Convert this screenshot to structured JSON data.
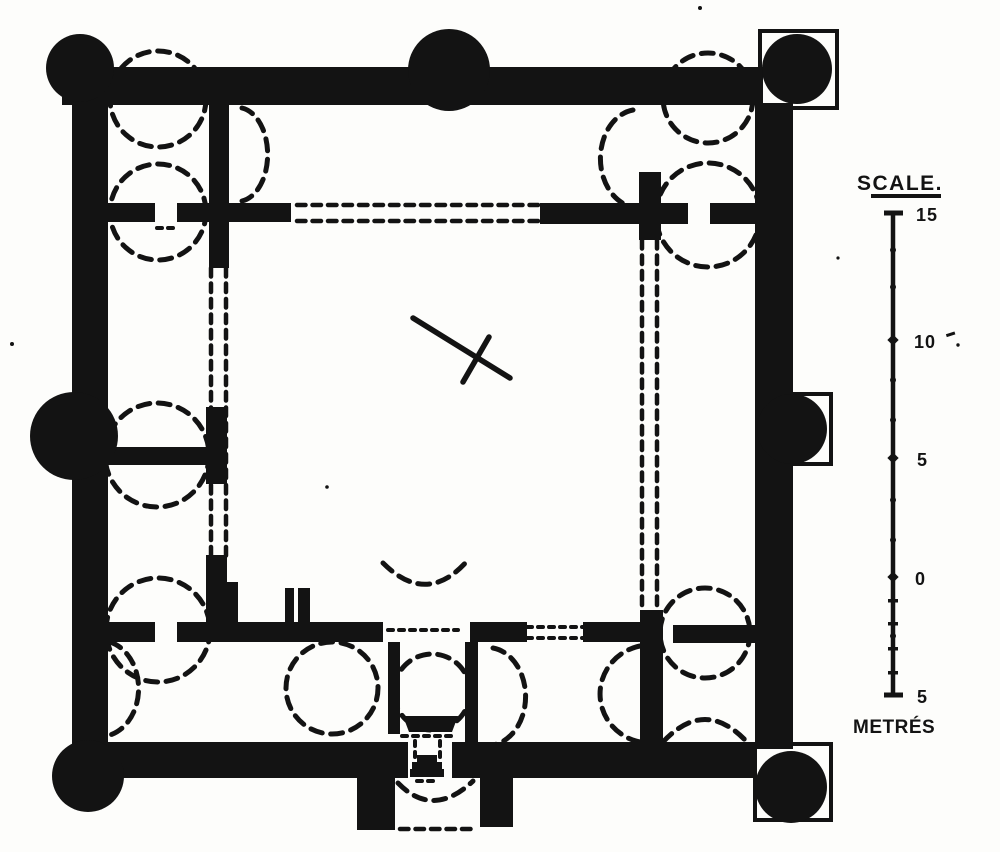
{
  "figure": {
    "kind": "scanned-ground-plan",
    "ink_color": "#131313",
    "paper_color": "#fdfdfb"
  },
  "scale_bar": {
    "title": "SCALE.",
    "unit_label": "METRÉS",
    "tick_labels": [
      "15",
      "10",
      "5",
      "0",
      "5"
    ]
  }
}
